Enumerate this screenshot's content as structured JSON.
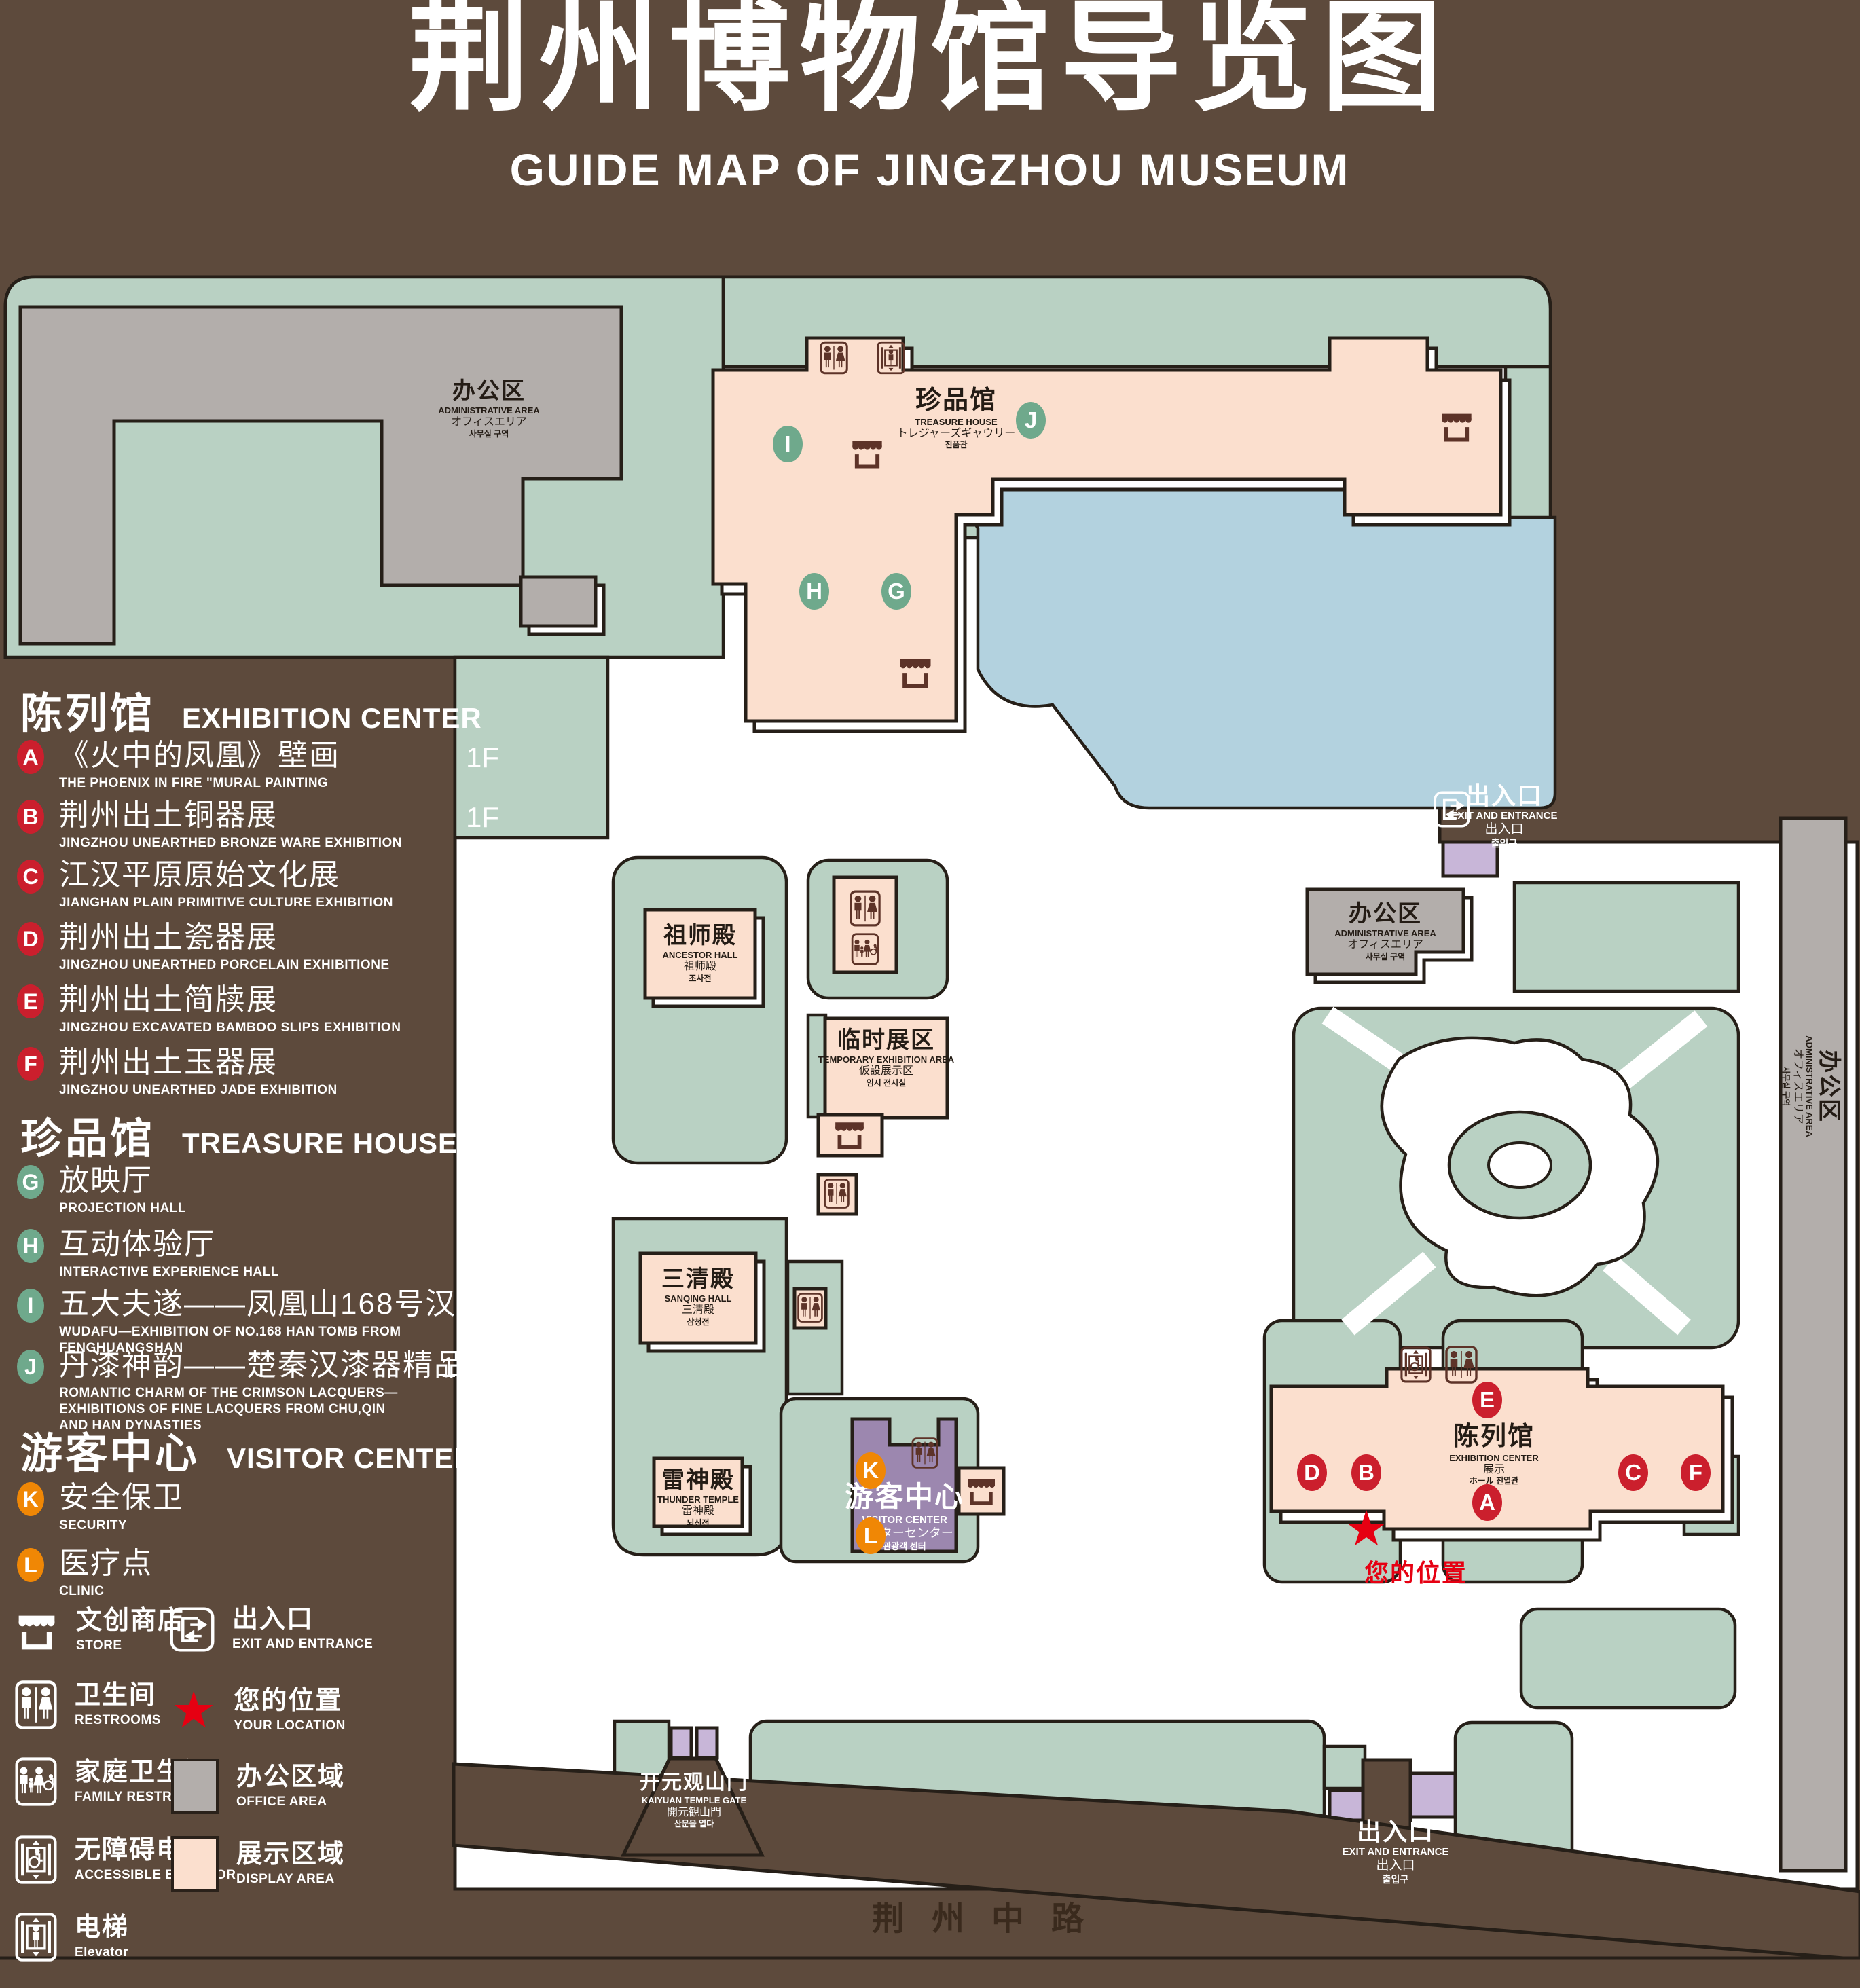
{
  "title": {
    "zh": "荆州博物馆导览图",
    "en": "GUIDE MAP OF JINGZHOU MUSEUM"
  },
  "colors": {
    "background": "#5d4a3c",
    "lawn": "#b9d1c3",
    "display_area": "#fbdfce",
    "office_area": "#b3aeab",
    "lake": "#b3d2df",
    "visitor_center": "#9c87af",
    "light_purple": "#c8b6d8",
    "badge_red": "#cb1f2d",
    "badge_green": "#6fa98c",
    "badge_orange": "#f08705",
    "location_red": "#e60012",
    "icon_brown": "#5d3328"
  },
  "legend": {
    "sections": [
      {
        "zh": "陈列馆",
        "en": "EXHIBITION CENTER",
        "items": [
          {
            "letter": "A",
            "zh": "《火中的凤凰》壁画",
            "en": "THE PHOENIX IN FIRE \"MURAL PAINTING",
            "floor": "1F"
          },
          {
            "letter": "B",
            "zh": "荆州出土铜器展",
            "en": "JINGZHOU UNEARTHED BRONZE WARE EXHIBITION",
            "floor": "1F"
          },
          {
            "letter": "C",
            "zh": "江汉平原原始文化展",
            "en": "JIANGHAN PLAIN PRIMITIVE CULTURE EXHIBITION",
            "floor": "1F"
          },
          {
            "letter": "D",
            "zh": "荆州出土瓷器展",
            "en": "JINGZHOU UNEARTHED PORCELAIN EXHIBITIONE",
            "floor": "2F"
          },
          {
            "letter": "E",
            "zh": "荆州出土简牍展",
            "en": "JINGZHOU EXCAVATED BAMBOO SLIPS EXHIBITION",
            "floor": "2F"
          },
          {
            "letter": "F",
            "zh": "荆州出土玉器展",
            "en": "JINGZHOU UNEARTHED JADE EXHIBITION",
            "floor": "2F"
          }
        ]
      },
      {
        "zh": "珍品馆",
        "en": "TREASURE HOUSE",
        "items": [
          {
            "letter": "G",
            "zh": "放映厅",
            "en": "PROJECTION HALL",
            "floor": "1F"
          },
          {
            "letter": "H",
            "zh": "互动体验厅",
            "en": "INTERACTIVE EXPERIENCE HALL",
            "floor": "1F"
          },
          {
            "letter": "I",
            "zh": "五大夫遂——凤凰山168号汉墓展",
            "en": "WUDAFU—EXHIBITION OF NO.168 HAN TOMB FROM FENGHUANGSHAN",
            "floor": "2F"
          },
          {
            "letter": "J",
            "zh": "丹漆神韵——楚秦汉漆器精品展",
            "en": "ROMANTIC CHARM OF THE CRIMSON LACQUERS—EXHIBITIONS OF FINE LACQUERS FROM CHU,QIN AND HAN DYNASTIES",
            "floor": "1-2F"
          }
        ]
      },
      {
        "zh": "游客中心",
        "en": "VISITOR CENTER",
        "items": [
          {
            "letter": "K",
            "zh": "安全保卫",
            "en": "SECURITY",
            "floor": "1F"
          },
          {
            "letter": "L",
            "zh": "医疗点",
            "en": "CLINIC",
            "floor": "1F"
          }
        ]
      }
    ],
    "symbols_left": [
      {
        "zh": "文创商店",
        "en": "STORE"
      },
      {
        "zh": "卫生间",
        "en": "RESTROOMS"
      },
      {
        "zh": "家庭卫生间",
        "en": "FAMILY RESTROOMS"
      },
      {
        "zh": "无障碍电梯",
        "en": "ACCESSIBLE ELEVATOR"
      },
      {
        "zh": "电梯",
        "en": "Elevator"
      }
    ],
    "symbols_right": [
      {
        "zh": "出入口",
        "en": "EXIT AND ENTRANCE"
      },
      {
        "zh": "您的位置",
        "en": "YOUR LOCATION"
      },
      {
        "zh": "办公区域",
        "en": "OFFICE AREA"
      },
      {
        "zh": "展示区域",
        "en": "DISPLAY AREA"
      }
    ]
  },
  "map": {
    "labels": {
      "admin_tl": {
        "zh": "办公区",
        "en": "ADMINISTRATIVE AREA",
        "l3": "オフィスエリア",
        "l4": "사무실 구역"
      },
      "treasure": {
        "zh": "珍品馆",
        "en": "TREASURE HOUSE",
        "l3": "トレジャーズギャウリー",
        "l4": "진품관"
      },
      "ancestor": {
        "zh": "祖师殿",
        "en": "ANCESTOR HALL",
        "l3": "祖师殿",
        "l4": "조사전"
      },
      "temp": {
        "zh": "临时展区",
        "en": "TEMPORARY EXHIBITION AREA",
        "l3": "仮設展示区",
        "l4": "임시 전시실"
      },
      "sanqing": {
        "zh": "三清殿",
        "en": "SANQING HALL",
        "l3": "三清殿",
        "l4": "삼청전"
      },
      "thunder": {
        "zh": "雷神殿",
        "en": "THUNDER TEMPLE",
        "l3": "雷神殿",
        "l4": "뇌신전"
      },
      "visitor": {
        "zh": "游客中心",
        "en": "VISITOR CENTER",
        "l3": "ビジターセンター",
        "l4": "관광객 센터"
      },
      "exhibition": {
        "zh": "陈列馆",
        "en": "EXHIBITION CENTER",
        "l3": "展示",
        "l4": "ホール 진열관"
      },
      "admin_r": {
        "zh": "办公区",
        "en": "ADMINISTRATIVE AREA",
        "l3": "オフィスエリア",
        "l4": "사무실 구역"
      },
      "admin_fr": {
        "zh": "办公区",
        "en": "ADMINISTRATIVE AREA",
        "l3": "オフィスエリア",
        "l4": "사무실 구역"
      },
      "exit_tr": {
        "zh": "出入口",
        "en": "EXIT AND ENTRANCE",
        "l3": "出入口",
        "l4": "출입구"
      },
      "exit_br": {
        "zh": "出入口",
        "en": "EXIT AND ENTRANCE",
        "l3": "出入口",
        "l4": "출입구"
      },
      "gate": {
        "zh": "开元观山门",
        "en": "KAIYUAN TEMPLE GATE",
        "l3": "開元観山門",
        "l4": "산문을 열다"
      }
    },
    "letters": [
      "A",
      "B",
      "C",
      "D",
      "E",
      "F",
      "G",
      "H",
      "I",
      "J",
      "K",
      "L"
    ],
    "road": "荆州中路",
    "your_location": "您的位置",
    "star": "★"
  }
}
